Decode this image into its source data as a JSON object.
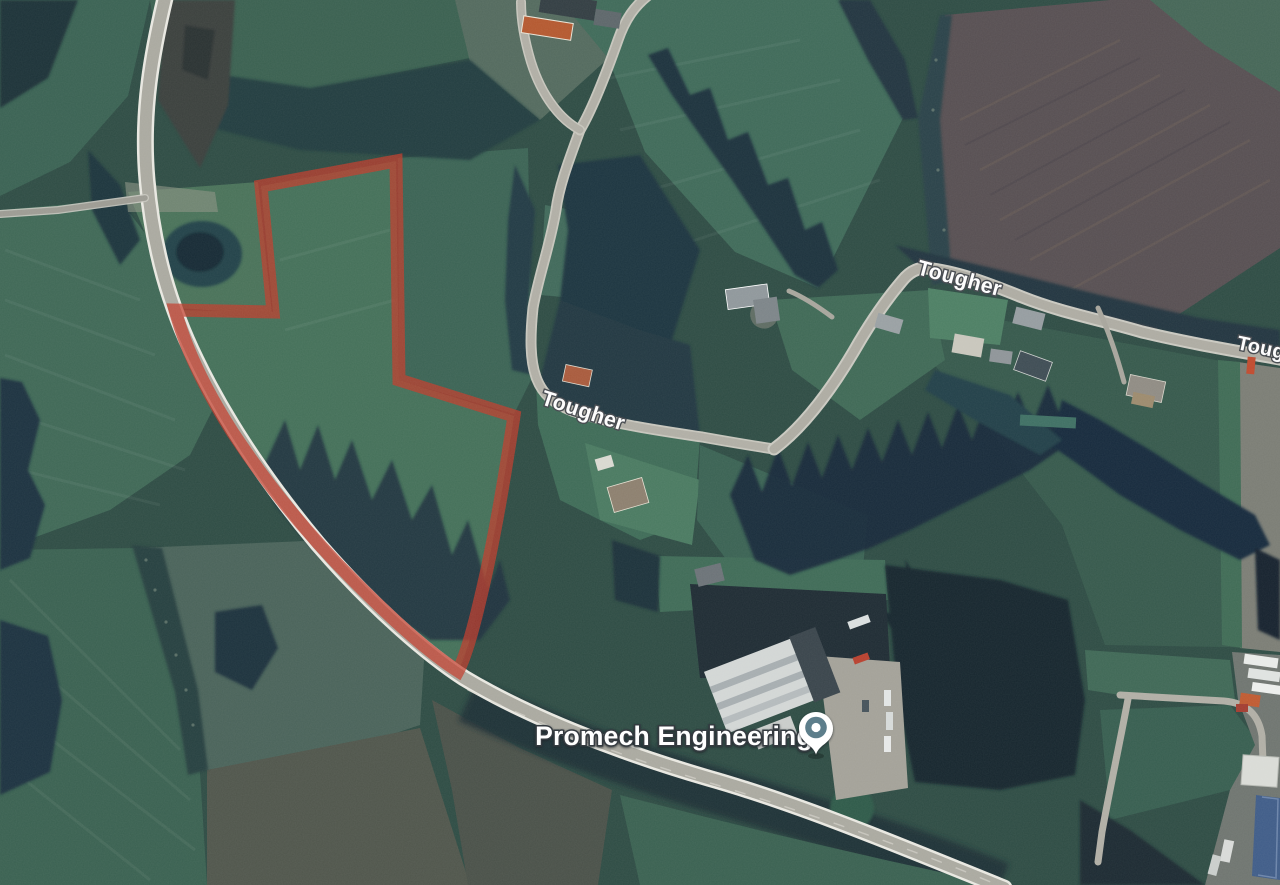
{
  "map": {
    "road_labels": [
      "Tougher",
      "Tougher",
      "Tougher"
    ],
    "place": {
      "name": "Promech Engineering"
    },
    "marker": {
      "icon": "map-pin-icon",
      "color": "#5d7e8b"
    },
    "boundary": {
      "color": "#c23a2a",
      "opacity": "0.72"
    }
  }
}
